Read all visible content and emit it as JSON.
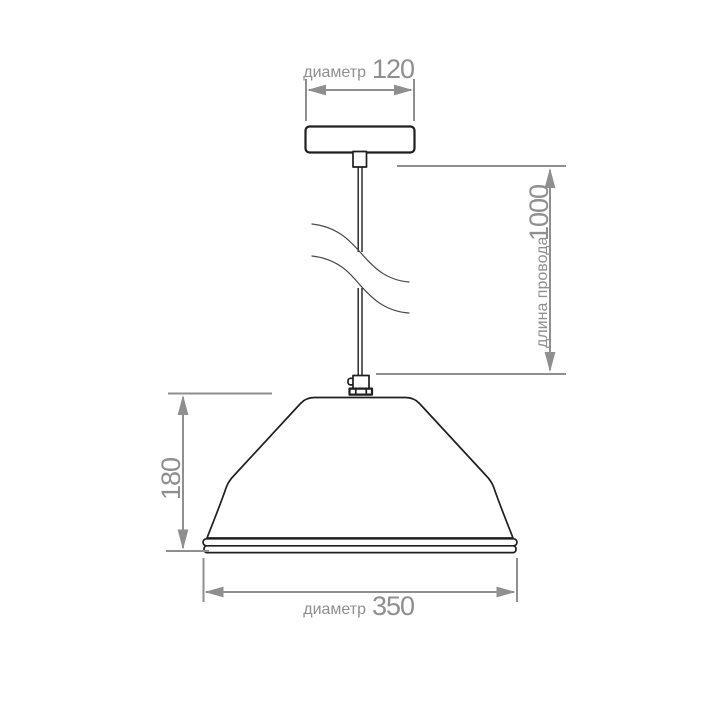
{
  "figure": {
    "background": "#ffffff",
    "colors": {
      "dimension_gray": "#8f8f8f",
      "outline_black": "#1f1f1f",
      "break_line_gray": "#4a4a4a"
    },
    "dimensions": {
      "canopy_diameter": {
        "prefix": "диаметр",
        "value": "120"
      },
      "cord_length": {
        "prefix": "длина провода",
        "value": "1000"
      },
      "shade_height": {
        "value": "180"
      },
      "shade_diameter": {
        "prefix": "диаметр",
        "value": "350"
      }
    }
  }
}
